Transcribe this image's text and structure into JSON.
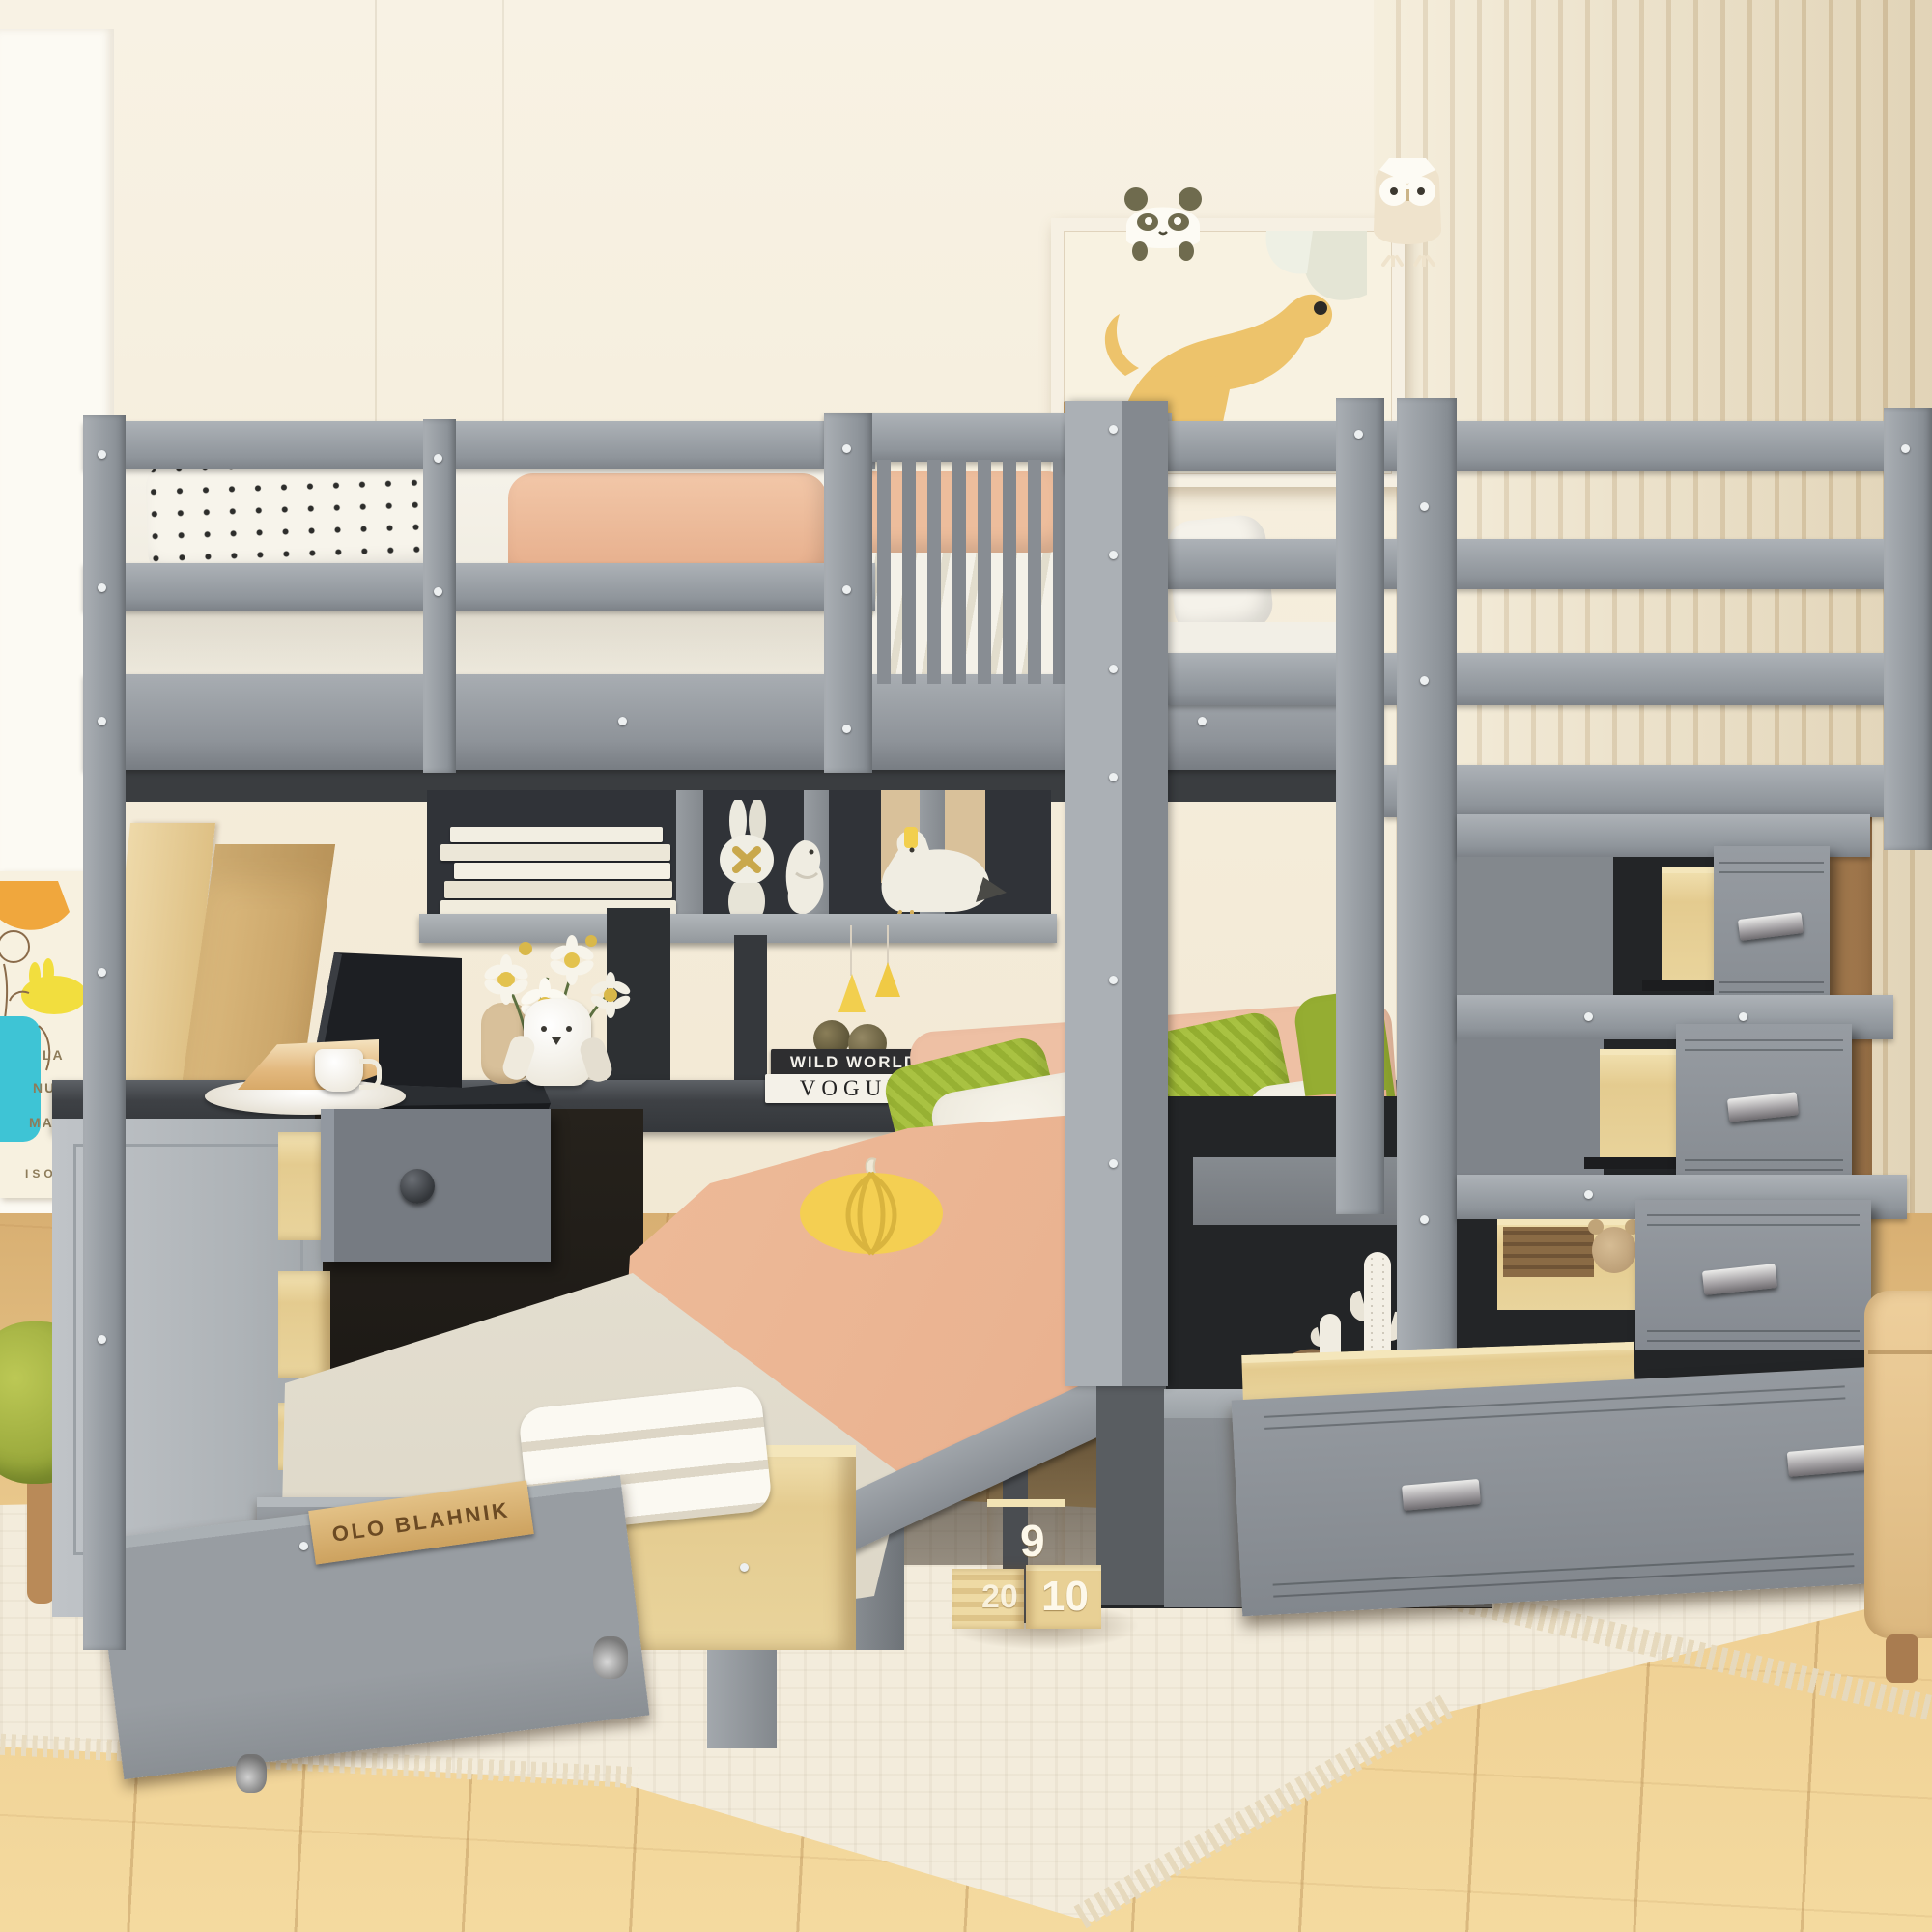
{
  "decor_text": {
    "book_stack": {
      "top_spine": "WILD WORLD",
      "bottom_spine": "VOGUE"
    },
    "trundle_book_spine": "OLO BLAHNIK",
    "poster": {
      "line1": "LA",
      "line2": "NUEVA",
      "line3": "MASC",
      "signature": "ISOL"
    },
    "number_blocks": {
      "stacked_top": "9",
      "bottom_left": "20",
      "bottom_right": "10"
    }
  },
  "palette": {
    "wall_cream": "#f6efe0",
    "wall_white": "#fcfaf3",
    "slat_wall": "#f0e6cd",
    "wood_headboard": "#dfbc86",
    "wood_wardrobe": "#b2854f",
    "floor_wood": "#e7c487",
    "rug": "#f3ecdc",
    "frame_gray_light": "#9ba0a5",
    "frame_gray_dark": "#55585c",
    "drawer_maple": "#ecd7a0",
    "duvet_peach": "#f0bf9f",
    "pillow_green": "#a7c040",
    "accent_yellow": "#f2cf4e"
  },
  "objects": [
    "loft bunk bed",
    "guard rails",
    "twin bed",
    "storage staircase with pull-out drawers",
    "corner desk with laptop",
    "bookshelf cubbies",
    "trundle drawer on casters",
    "wall art with dog print",
    "panda figure",
    "owl figure",
    "bunny figurine",
    "seagull plush",
    "flower vase",
    "pumpkin pillow",
    "number blocks",
    "cactus figurines",
    "green stool",
    "area rug"
  ]
}
